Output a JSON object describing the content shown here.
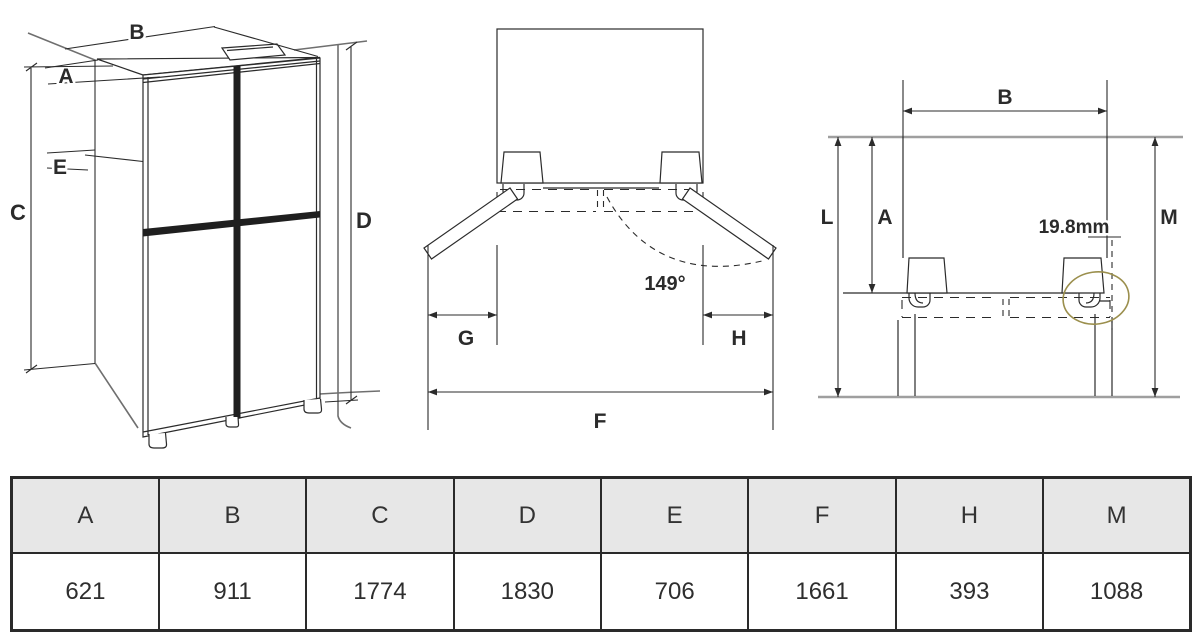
{
  "views": {
    "isometric": {
      "title": "isometric-view-of-four-door-fridge",
      "labels": {
        "B": "B",
        "A": "A",
        "E": "E",
        "C": "C",
        "D": "D"
      }
    },
    "doors_open": {
      "title": "top-view-doors-open",
      "labels": {
        "G": "G",
        "H": "H",
        "F": "F"
      },
      "door_angle": "149°"
    },
    "clearance": {
      "title": "top-view-clearance",
      "labels": {
        "B": "B",
        "L": "L",
        "A": "A",
        "M": "M"
      },
      "hinge_gap": "19.8mm"
    }
  },
  "table": {
    "columns": [
      {
        "header": "A",
        "value": "621"
      },
      {
        "header": "B",
        "value": "911"
      },
      {
        "header": "C",
        "value": "1774"
      },
      {
        "header": "D",
        "value": "1830"
      },
      {
        "header": "E",
        "value": "706"
      },
      {
        "header": "F",
        "value": "1661"
      },
      {
        "header": "H",
        "value": "393"
      },
      {
        "header": "M",
        "value": "1088"
      }
    ]
  },
  "colors": {
    "line": "#2b2b2b",
    "wall_gray": "#9f9f9f",
    "niche_gray": "#6f6f6f",
    "highlight_ellipse": "#9b8f4d",
    "table_header_bg": "#e7e7e7",
    "table_border": "#2a2a2a",
    "background": "#ffffff"
  }
}
